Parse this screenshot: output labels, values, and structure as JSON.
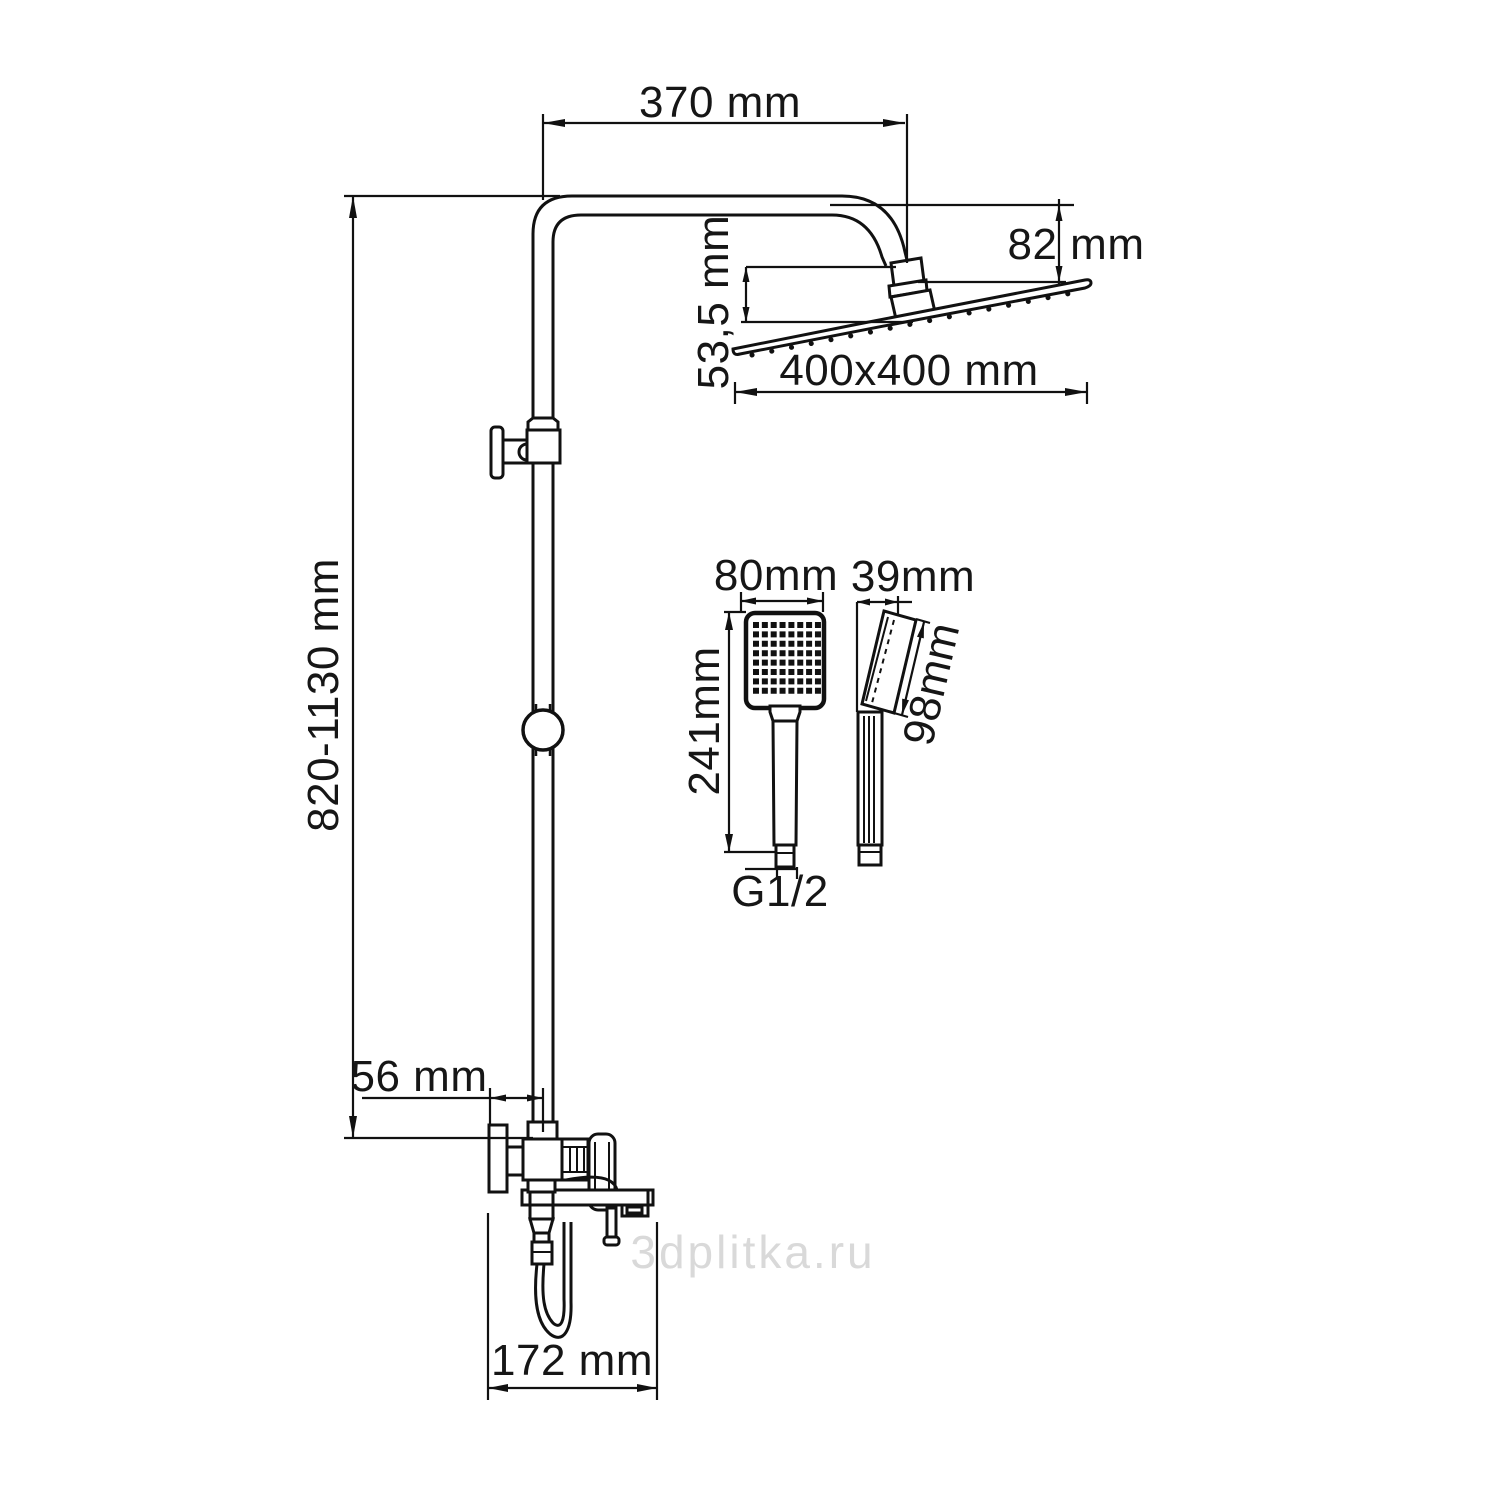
{
  "drawing": {
    "dimensions": {
      "arm_reach": "370 mm",
      "head_height": "82 mm",
      "head_drop": "53,5 mm",
      "overhead_size": "400x400 mm",
      "column_height": "820-1130 mm",
      "handshower_width": "80mm",
      "handshower_depth": "39mm",
      "handshower_length": "241mm",
      "handshower_head_length": "98mm",
      "thread": "G1/2",
      "wall_offset": "56 mm",
      "spout_reach": "172 mm"
    },
    "watermark": "3dplitka.ru",
    "colors": {
      "line": "#111111",
      "watermark": "#d9d9d9",
      "background": "#ffffff"
    }
  }
}
